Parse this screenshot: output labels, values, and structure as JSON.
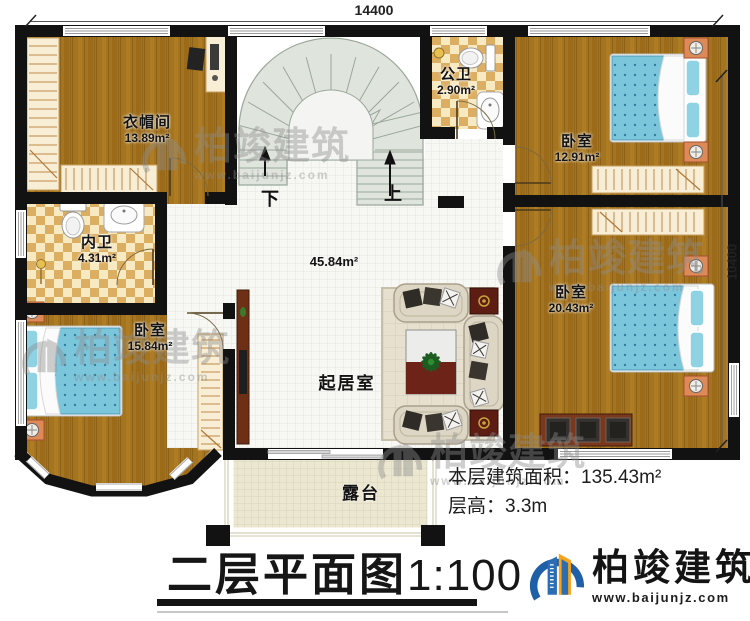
{
  "plan": {
    "dimensions": {
      "width": "14400",
      "height": "10400"
    },
    "rooms": [
      {
        "id": "cloakroom",
        "name": "衣帽间",
        "area": "13.89m²"
      },
      {
        "id": "public-bath",
        "name": "公卫",
        "area": "2.90m²"
      },
      {
        "id": "bedroom-ne",
        "name": "卧室",
        "area": "12.91m²"
      },
      {
        "id": "private-bath",
        "name": "内卫",
        "area": "4.31m²"
      },
      {
        "id": "bedroom-se",
        "name": "卧室",
        "area": "20.43m²"
      },
      {
        "id": "bedroom-sw",
        "name": "卧室",
        "area": "15.84m²"
      },
      {
        "id": "living-room",
        "name": "起居室",
        "area": "45.84m²"
      },
      {
        "id": "terrace",
        "name": "露台"
      }
    ],
    "stairs": {
      "down_label": "下",
      "up_label": "上"
    }
  },
  "notes": {
    "area_label": "本层建筑面积：",
    "area_value": "135.43m²",
    "height_label": "层高：",
    "height_value": "3.3m"
  },
  "title": {
    "text": "二层平面图",
    "scale": "1:100"
  },
  "brand": {
    "name": "柏竣建筑",
    "url": "www.baijunjz.com"
  },
  "watermark": {
    "name": "柏竣建筑",
    "url": "www.baijunjz.com"
  },
  "colors": {
    "wall": "#121212",
    "wood_floor": "#a5741f",
    "tile_floor": "#f7f7f4",
    "terrace_floor": "#ebe7d1",
    "bath_tile": "#f7e9c2",
    "stairs": "#dfe4dc",
    "bed_blue": "#7cc6dc",
    "logo_blue": "#1f5fa8",
    "logo_orange": "#f7a41d"
  }
}
